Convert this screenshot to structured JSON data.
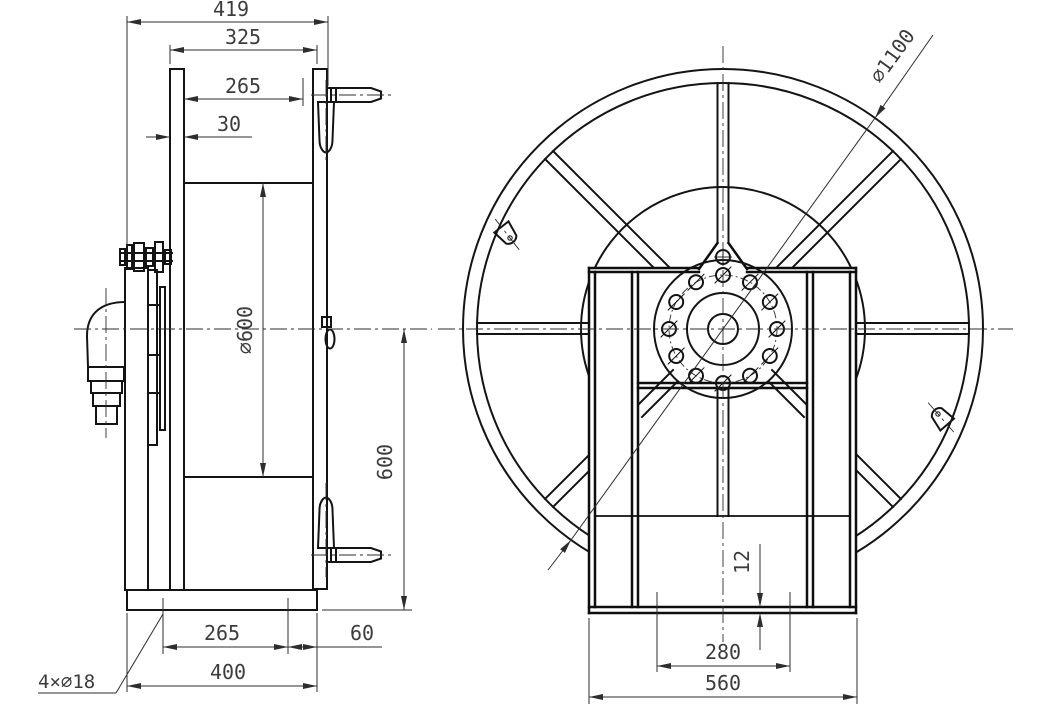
{
  "page": {
    "background": "#ffffff",
    "line_color": "#141414",
    "dim_color": "#3c3c3c"
  },
  "side_view": {
    "dim_overall_width": "419",
    "dim_flange_spacing": "325",
    "dim_drum_inner_width": "265",
    "dim_flange_thickness": "30",
    "dim_drum_diameter": "∅600",
    "dim_axis_height": "600",
    "dim_base_hole_spacing": "265",
    "dim_base_edge_offset": "60",
    "dim_base_length": "400",
    "callout_mounting_holes": "4×∅18"
  },
  "front_view": {
    "dim_flange_diameter": "∅1100",
    "dim_base_plate_thickness": "12",
    "dim_base_hole_spacing": "280",
    "dim_frame_width": "560"
  }
}
